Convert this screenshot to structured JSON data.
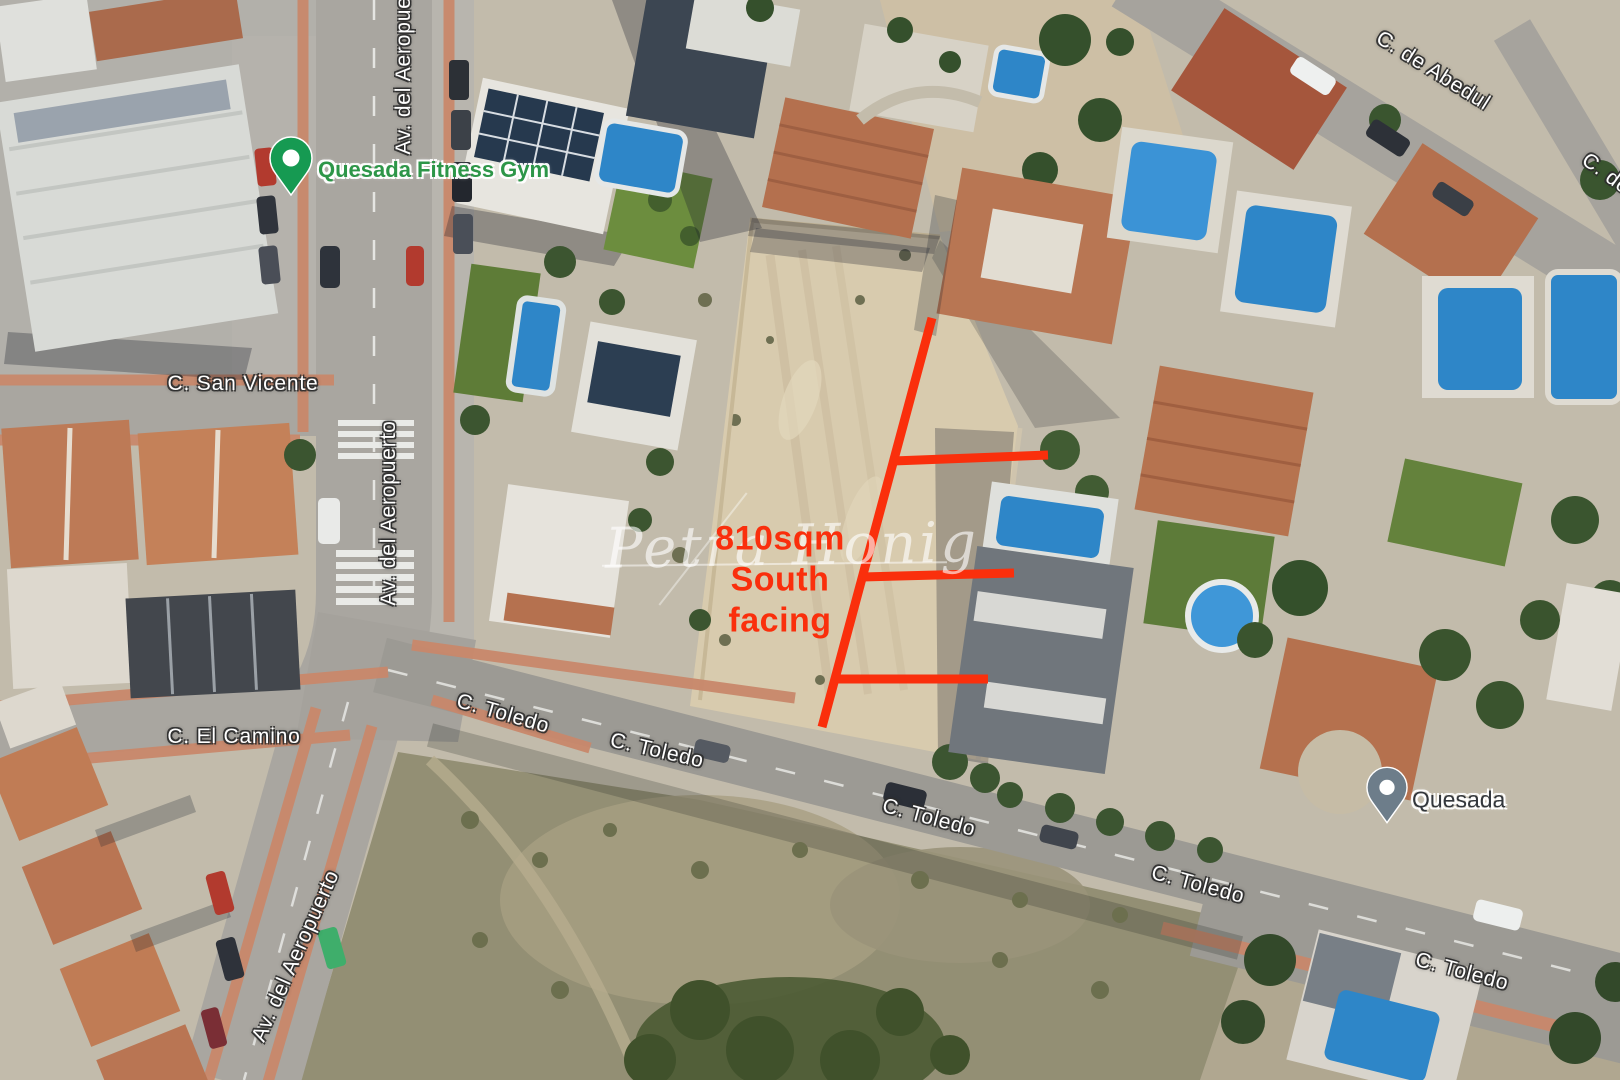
{
  "colors": {
    "annotation_red": "#fa2f0c",
    "gym_label_green": "#2d9648",
    "gym_pin_green": "#169a52",
    "quesada_pin_gray": "#6d7d8a",
    "quesada_label_dark": "#33373c"
  },
  "streets": {
    "av_del_aeropuerto": [
      "Av. del Aeropuerto",
      "Av. del Aeropuerto",
      "Av. del Aeropuerto"
    ],
    "san_vicente": "C. San Vicente",
    "el_camino": "C. El Camino",
    "de_abedul": "C. de Abedul",
    "de_abedul_partial": "C. de",
    "toledo": [
      "C. Toledo",
      "C. Toledo",
      "C. Toledo",
      "C. Toledo",
      "C. Toledo"
    ]
  },
  "places": {
    "gym": "Quesada Fitness Gym",
    "quesada": "Quesada"
  },
  "plot_annotation": {
    "area": "810sqm",
    "line2": "South",
    "line3": "facing"
  },
  "watermark": "Petra Honig"
}
